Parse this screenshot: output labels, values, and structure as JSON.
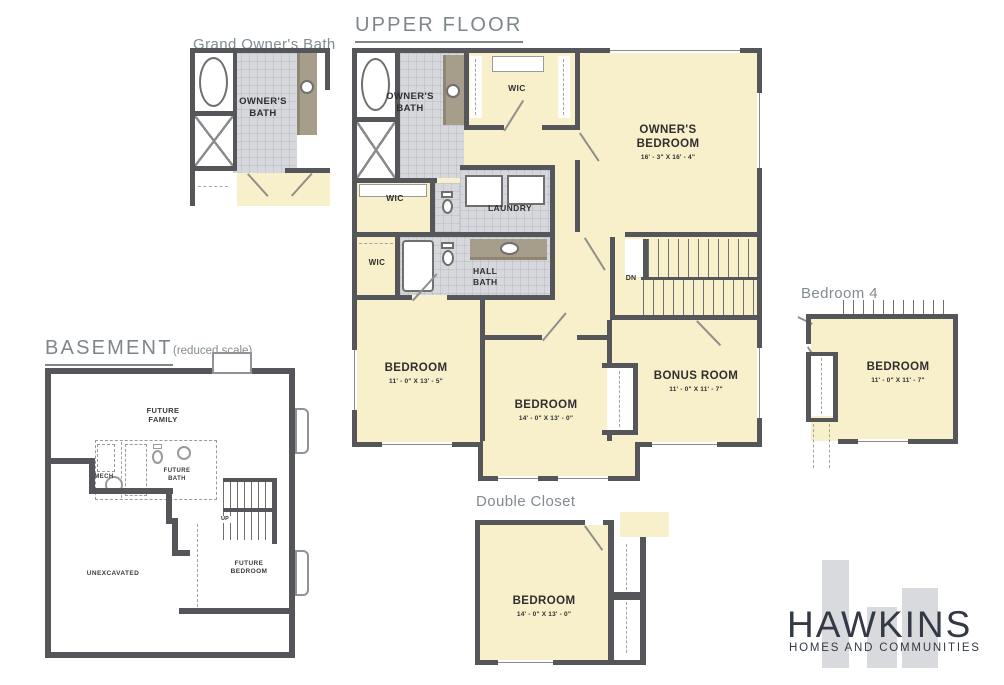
{
  "colors": {
    "room_yellow": "#f7f0ca",
    "tile_gray": "#d6d8dd",
    "wall_dark": "#55565a",
    "vanity_taupe": "#a69e8a",
    "heading_gray": "#7d868b",
    "label_dark": "#2f2f2f",
    "logo_navy": "#333a46",
    "logo_bar_gray": "#d8dade"
  },
  "icons": {
    "bathtub-icon": "oval-in-alcove",
    "shower-icon": "x-cross-square",
    "toilet-icon": "ellipse-with-tank",
    "sink-icon": "circle-basin",
    "washer-icon": "outlined-square",
    "dryer-icon": "outlined-square",
    "stairs-icon": "hatched-treads",
    "water-heater-icon": "circle",
    "window-icon": "thin-double-line",
    "door-icon": "angled-leaf-line"
  },
  "headings": {
    "upper_floor": "UPPER FLOOR",
    "grand_owners_bath": "Grand Owner's Bath",
    "bedroom4": "Bedroom 4",
    "double_closet": "Double Closet",
    "basement": "BASEMENT",
    "basement_note": "(reduced scale)"
  },
  "upper": {
    "owners_bath": "OWNER'S\nBATH",
    "wic_top": "WIC",
    "wic_mid": "WIC",
    "wic_low": "WIC",
    "laundry": "LAUNDRY",
    "hall_bath": "HALL\nBATH",
    "owners_bedroom": "OWNER'S\nBEDROOM",
    "owners_bedroom_dims": "16' - 3\" X 16' - 4\"",
    "dn": "DN",
    "bedroom_left": "BEDROOM",
    "bedroom_left_dims": "11' - 0\" X 13' - 5\"",
    "bedroom_center": "BEDROOM",
    "bedroom_center_dims": "14' - 0\" X 13' - 0\"",
    "bonus": "BONUS ROOM",
    "bonus_dims": "11' - 0\" X 11' - 7\""
  },
  "grand_bath": {
    "owners_bath": "OWNER'S\nBATH"
  },
  "bedroom4": {
    "label": "BEDROOM",
    "dims": "11' - 0\" X 11' - 7\""
  },
  "double_closet": {
    "label": "BEDROOM",
    "dims": "14' - 0\" X 13' - 0\""
  },
  "basement": {
    "future_family": "FUTURE\nFAMILY",
    "mech": "MECH",
    "future_bath": "FUTURE\nBATH",
    "up": "UP",
    "future_bedroom": "FUTURE\nBEDROOM",
    "unexcavated": "UNEXCAVATED"
  },
  "logo": {
    "name": "HAWKINS",
    "tagline": "HOMES AND COMMUNITIES"
  }
}
